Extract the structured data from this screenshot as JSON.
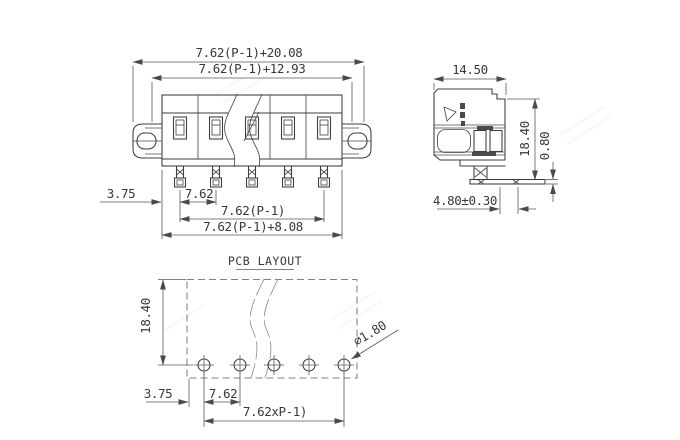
{
  "drawing": {
    "front_view": {
      "dim_overall_width": "7.62(P-1)+20.08",
      "dim_inner_width": "7.62(P-1)+12.93",
      "dim_edge_offset": "3.75",
      "dim_pitch": "7.62",
      "dim_pin_span": "7.62(P-1)",
      "dim_body_width": "7.62(P-1)+8.08"
    },
    "side_view": {
      "dim_depth": "14.50",
      "dim_height": "18.40",
      "dim_pin_thickness": "0.80",
      "dim_pin_length": "4.80±0.30"
    },
    "pcb_layout": {
      "title": "PCB LAYOUT",
      "dim_row_offset": "18.40",
      "dim_edge_offset": "3.75",
      "dim_pitch": "7.62",
      "dim_span": "7.62xP-1)",
      "dim_hole_diameter": "∅1.80"
    },
    "colors": {
      "line": "#3c3c3c",
      "dimension": "#4a4a4a",
      "text": "#383838",
      "background": "#ffffff"
    }
  }
}
